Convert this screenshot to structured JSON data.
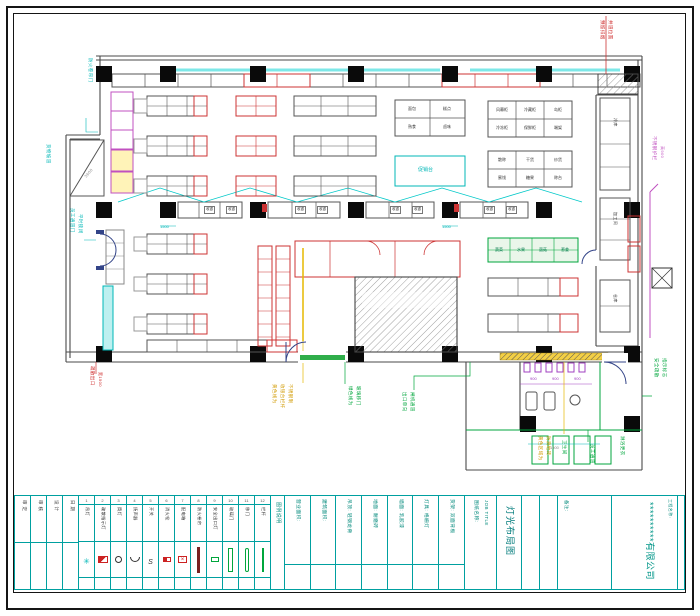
{
  "sheet": {
    "company": "**********有限公司",
    "labels": {
      "job_title_label": "图纸名称:",
      "job_title_en": "JOB TITLE",
      "drawing_title": "灯光布局图",
      "project_label": "工程名称:",
      "notes_label": "备注:",
      "legend_header": "图例说明"
    },
    "colors": {
      "teal": "#00a0a0",
      "cyan": "#00b7b7",
      "red": "#cc2222",
      "magenta": "#c050c0",
      "green": "#00a63c",
      "yellow": "#d19a00",
      "wall": "#4a4a4a"
    }
  },
  "titleblock": {
    "sign_cols": [
      {
        "label": "审 定"
      },
      {
        "label": "审 核"
      },
      {
        "label": "设 计"
      },
      {
        "label": "日 期"
      }
    ],
    "legend": [
      {
        "num": "1",
        "label": "吊灯",
        "symbol": "sym-pendant"
      },
      {
        "num": "2",
        "label": "疏散指示灯",
        "symbol": "sym-exit-sign"
      },
      {
        "num": "3",
        "label": "筒灯",
        "symbol": "sym-downlight"
      },
      {
        "num": "4",
        "label": "扬声器",
        "symbol": "sym-speaker"
      },
      {
        "num": "5",
        "label": "开关",
        "symbol": "sym-switch"
      },
      {
        "num": "6",
        "label": "消火栓",
        "symbol": "sym-hydrant"
      },
      {
        "num": "7",
        "label": "配电箱",
        "symbol": "sym-distbox"
      },
      {
        "num": "8",
        "label": "防火卷帘",
        "symbol": "sym-shutter"
      },
      {
        "num": "9",
        "label": "安全出口灯",
        "symbol": "sym-exitlight"
      },
      {
        "num": "10",
        "label": "玻璃门",
        "symbol": "sym-glassdoor"
      },
      {
        "num": "11",
        "label": "移门",
        "symbol": "sym-slidedoor"
      },
      {
        "num": "12",
        "label": "栏杆",
        "symbol": "sym-railing"
      }
    ],
    "info_cols": [
      {
        "label": "营业面积:"
      },
      {
        "label": "建筑面积:"
      },
      {
        "label": "吊顶: 轻钢龙骨"
      },
      {
        "label": "地面: 耐磨砖"
      },
      {
        "label": "墙面: 乳胶漆"
      },
      {
        "label": "灯具: 格栅灯"
      },
      {
        "label": "货架: 双面背板"
      }
    ]
  },
  "plan": {
    "annotations": [
      {
        "text": "防火卷帘门",
        "cls": "vtext",
        "style": "left:92px;top:58px;color:#00b7b7;font-size:4.5px"
      },
      {
        "text": "货物坡道",
        "cls": "vtext",
        "style": "left:50px;top:144px;color:#00b7b7;font-size:4.5px"
      },
      {
        "text": "员工通道门",
        "cls": "vtext",
        "style": "left:74px;top:208px;color:#00b7b7;font-size:4.5px"
      },
      {
        "text": "平时锁闭",
        "cls": "vtext",
        "style": "left:82px;top:214px;color:#00b7b7;font-size:4.5px"
      },
      {
        "text": "促销台",
        "cls": "htext",
        "style": "left:418px;top:168px;color:#00b7b7;font-size:5px"
      },
      {
        "text": "1500",
        "cls": "htext",
        "style": "left:160px;top:225px;color:#00b7b7;font-size:4px"
      },
      {
        "text": "1500",
        "cls": "htext",
        "style": "left:442px;top:225px;color:#00b7b7;font-size:4px"
      },
      {
        "text": "疏散出口",
        "cls": "vtext",
        "style": "left:94px;top:366px;color:#cc2222;font-size:4.5px"
      },
      {
        "text": "宽1500",
        "cls": "vtext",
        "style": "left:102px;top:372px;color:#cc2222;font-size:4px"
      },
      {
        "text": "预留排烟",
        "cls": "vtext",
        "style": "left:604px;top:20px;color:#cc2222;font-size:4.5px"
      },
      {
        "text": "井道位置",
        "cls": "vtext",
        "style": "left:612px;top:20px;color:#cc2222;font-size:4.5px"
      },
      {
        "text": "不锈钢护栏",
        "cls": "vtext",
        "style": "left:656px;top:136px;color:#c050c0;font-size:4.5px"
      },
      {
        "text": "高900",
        "cls": "vtext",
        "style": "left:664px;top:146px;color:#c050c0;font-size:4px"
      },
      {
        "text": "黄色线为",
        "cls": "vtext",
        "style": "left:276px;top:384px;color:#d19a00;font-size:4.5px"
      },
      {
        "text": "收银台栏杆",
        "cls": "vtext",
        "style": "left:284px;top:384px;color:#d19a00;font-size:4.5px"
      },
      {
        "text": "不锈钢制",
        "cls": "vtext",
        "style": "left:292px;top:384px;color:#d19a00;font-size:4.5px"
      },
      {
        "text": "黄色区域为",
        "cls": "vtext",
        "style": "left:542px;top:436px;color:#d19a00;font-size:4.5px"
      },
      {
        "text": "防滑地砖",
        "cls": "vtext",
        "style": "left:550px;top:436px;color:#d19a00;font-size:4.5px"
      },
      {
        "text": "绿色线为",
        "cls": "vtext",
        "style": "left:352px;top:386px;color:#00a63c;font-size:4.5px"
      },
      {
        "text": "玻璃移门",
        "cls": "vtext",
        "style": "left:360px;top:386px;color:#00a63c;font-size:4.5px"
      },
      {
        "text": "出口单向",
        "cls": "vtext",
        "style": "left:406px;top:392px;color:#00a63c;font-size:4.5px"
      },
      {
        "text": "闸机通道",
        "cls": "vtext",
        "style": "left:414px;top:392px;color:#00a63c;font-size:4.5px"
      },
      {
        "text": "卫生间",
        "cls": "vtext",
        "style": "left:566px;top:440px;color:#00a63c;font-size:4.5px"
      },
      {
        "text": "员工通道",
        "cls": "vtext",
        "style": "left:594px;top:444px;color:#00a63c;font-size:4.5px"
      },
      {
        "text": "淋浴更衣",
        "cls": "vtext",
        "style": "left:624px;top:436px;color:#00a63c;font-size:4.5px"
      },
      {
        "text": "安全疏散",
        "cls": "vtext",
        "style": "left:658px;top:358px;color:#00a63c;font-size:4.5px"
      },
      {
        "text": "指示标志",
        "cls": "vtext",
        "style": "left:666px;top:358px;color:#00a63c;font-size:4.5px"
      },
      {
        "text": "冷库",
        "cls": "vtext",
        "style": "left:617px;top:118px;color:#333;font-size:4px"
      },
      {
        "text": "加工间",
        "cls": "vtext",
        "style": "left:617px;top:212px;color:#333;font-size:4px"
      },
      {
        "text": "仓库",
        "cls": "vtext",
        "style": "left:617px;top:294px;color:#333;font-size:4px"
      },
      {
        "text": "面包",
        "cls": "ctext",
        "style": "left:412px;top:109px"
      },
      {
        "text": "糕点",
        "cls": "ctext",
        "style": "left:447px;top:109px"
      },
      {
        "text": "熟食",
        "cls": "ctext",
        "style": "left:412px;top:127px"
      },
      {
        "text": "卤味",
        "cls": "ctext",
        "style": "left:447px;top:127px"
      },
      {
        "text": "风幕柜",
        "cls": "ctext",
        "style": "left:502px;top:110px"
      },
      {
        "text": "冷藏柜",
        "cls": "ctext",
        "style": "left:530px;top:110px"
      },
      {
        "text": "岛柜",
        "cls": "ctext",
        "style": "left:558px;top:110px"
      },
      {
        "text": "冷冻柜",
        "cls": "ctext",
        "style": "left:502px;top:128px"
      },
      {
        "text": "保鲜柜",
        "cls": "ctext",
        "style": "left:530px;top:128px"
      },
      {
        "text": "端架",
        "cls": "ctext",
        "style": "left:558px;top:128px"
      },
      {
        "text": "散称",
        "cls": "ctext",
        "style": "left:502px;top:160px"
      },
      {
        "text": "干货",
        "cls": "ctext",
        "style": "left:530px;top:160px"
      },
      {
        "text": "炒货",
        "cls": "ctext",
        "style": "left:558px;top:160px"
      },
      {
        "text": "蜜饯",
        "cls": "ctext",
        "style": "left:502px;top:178px"
      },
      {
        "text": "糖果",
        "cls": "ctext",
        "style": "left:530px;top:178px"
      },
      {
        "text": "称台",
        "cls": "ctext",
        "style": "left:558px;top:178px"
      },
      {
        "text": "蔬菜",
        "cls": "ctext",
        "style": "left:499px;top:250px;color:#00794a"
      },
      {
        "text": "水果",
        "cls": "ctext",
        "style": "left:521px;top:250px;color:#00794a"
      },
      {
        "text": "菌菇",
        "cls": "ctext",
        "style": "left:543px;top:250px;color:#00794a"
      },
      {
        "text": "葱姜",
        "cls": "ctext",
        "style": "left:565px;top:250px;color:#00794a"
      },
      {
        "text": "收银",
        "cls": "cellbox",
        "style": "left:204px;top:206px"
      },
      {
        "text": "收银",
        "cls": "cellbox",
        "style": "left:226px;top:206px"
      },
      {
        "text": "收银",
        "cls": "cellbox",
        "style": "left:295px;top:206px"
      },
      {
        "text": "收银",
        "cls": "cellbox",
        "style": "left:317px;top:206px"
      },
      {
        "text": "收银",
        "cls": "cellbox",
        "style": "left:390px;top:206px"
      },
      {
        "text": "收银",
        "cls": "cellbox",
        "style": "left:412px;top:206px"
      },
      {
        "text": "收银",
        "cls": "cellbox",
        "style": "left:484px;top:206px"
      },
      {
        "text": "收银",
        "cls": "cellbox",
        "style": "left:506px;top:206px"
      },
      {
        "text": "900",
        "cls": "htext",
        "style": "left:530px;top:377px;color:#a040c0;font-size:4px"
      },
      {
        "text": "900",
        "cls": "htext",
        "style": "left:552px;top:377px;color:#a040c0;font-size:4px"
      },
      {
        "text": "900",
        "cls": "htext",
        "style": "left:574px;top:377px;color:#a040c0;font-size:4px"
      },
      {
        "text": "1500",
        "cls": "htext",
        "style": "left:550px;top:446px;color:#888;font-size:4px"
      },
      {
        "text": "3600",
        "cls": "vtext",
        "style": "left:84px;top:176px;color:#888;font-size:4px;transform:rotate(-50deg)"
      }
    ]
  }
}
